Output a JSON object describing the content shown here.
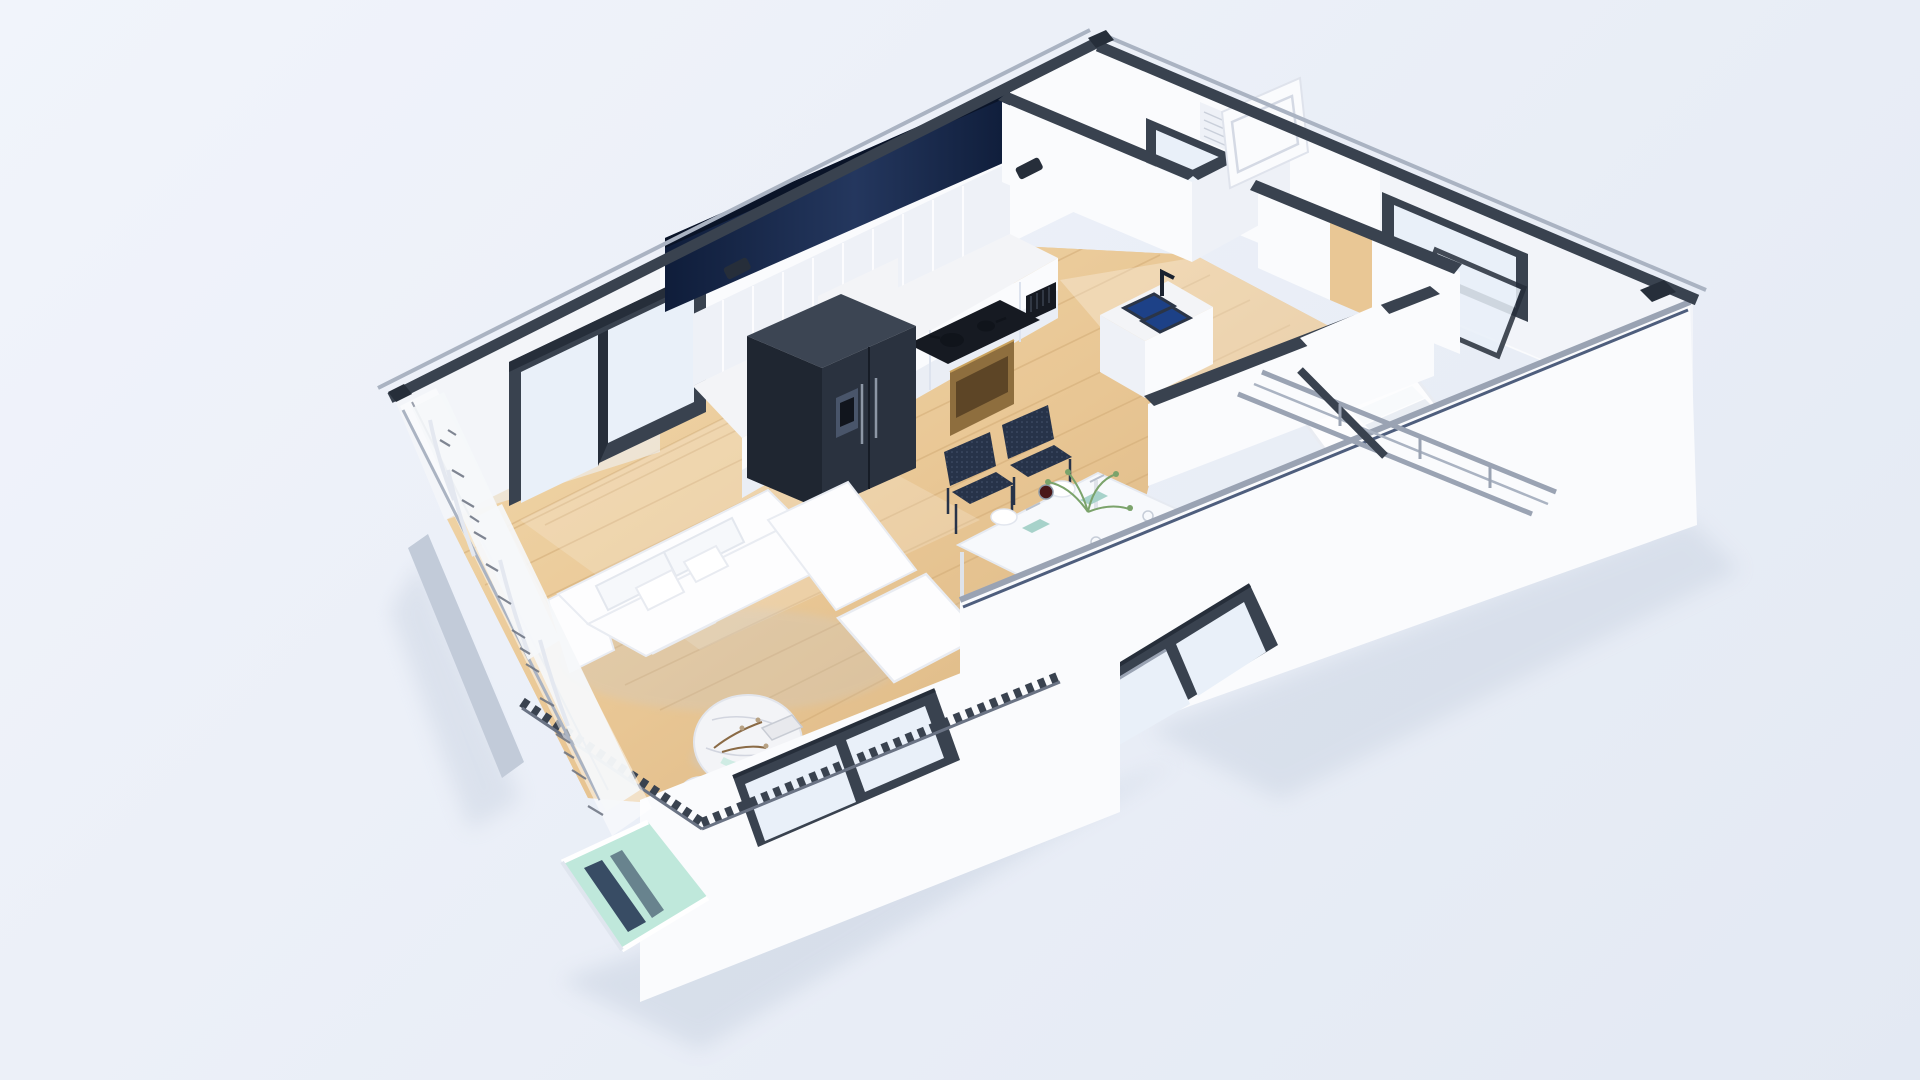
{
  "title": "3d-isometric-apartment-floor-plan-render",
  "colors": {
    "bg1": "#f1f4fb",
    "bg2": "#e3e9f3",
    "wall": "#fafbfd",
    "wallShade": "#eef1f7",
    "wallDark": "#dde3ee",
    "cap": "#39424f",
    "capDark": "#262e3a",
    "capLight": "#aab3c2",
    "navy1": "#0f1d3a",
    "navy2": "#24375e",
    "silver": "#9aa3b3",
    "wood": "#e9c795",
    "woodDark": "#d2ab77",
    "woodLight": "#f5e0b6",
    "marble": "#f3f4f7",
    "vein": "#c9cdd8",
    "fridge": "#2a323f",
    "fridgeTop": "#3c4553",
    "fridgeSide": "#1f2631",
    "black": "#161a22",
    "bronze": "#8e6e3e",
    "bronzeDark": "#5d4526",
    "chair": "#273349",
    "chairLight": "#45536d",
    "tableWhite": "#f7f9fc",
    "teal": "#a7d2ca",
    "maroon": "#4a1718",
    "plantGreen": "#7ba36b",
    "stem": "#8a6a45",
    "sofa": "#fdfdfe",
    "sofaShade": "#e9ecf2",
    "glass": "#e9f0f9",
    "glassTeal": "#bfe8db",
    "glassNavy": "#20304f",
    "curtain": "#f5f7fa",
    "shadow": "#c3cddd",
    "blueSink": "#1d4187"
  },
  "scene": {
    "view": "isometric-cutaway",
    "rooms": [
      "living-room",
      "dining-area",
      "kitchen",
      "hallway",
      "bathroom",
      "bedroom",
      "stairwell",
      "balcony-corner"
    ],
    "objects": [
      "wood-floor",
      "sofa",
      "coffee-table",
      "side-table",
      "dining-table",
      "dining-chairs",
      "refrigerator",
      "upper-cabinets",
      "navy-bulkhead",
      "cooktop",
      "oven",
      "kitchen-sink",
      "faucet",
      "bathroom-door",
      "bathroom-window",
      "bedroom-window",
      "staircase",
      "stair-railings",
      "curtains",
      "glass-wall",
      "teal-glass-panel",
      "front-window-left",
      "front-window-right",
      "roof-edge-rail-back",
      "roof-edge-rail-right",
      "serrated-parapet"
    ]
  }
}
